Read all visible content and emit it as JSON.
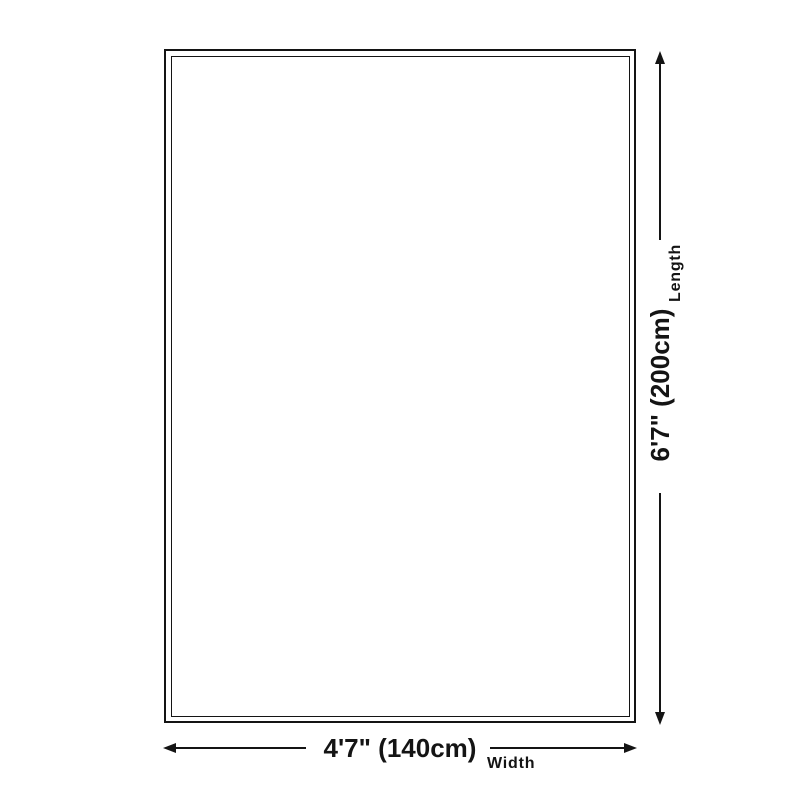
{
  "diagram": {
    "type": "product-size-diagram",
    "dimensions": {
      "width": {
        "value": "4'7\" (140cm)",
        "label": "Width"
      },
      "length": {
        "value": "6'7\" (200cm)",
        "label": "Length"
      }
    },
    "icons": [
      "arrow-left-icon",
      "arrow-right-icon",
      "arrow-up-icon",
      "arrow-down-icon"
    ],
    "colors": {
      "line": "#141414",
      "text": "#141414",
      "background": "#ffffff"
    }
  }
}
